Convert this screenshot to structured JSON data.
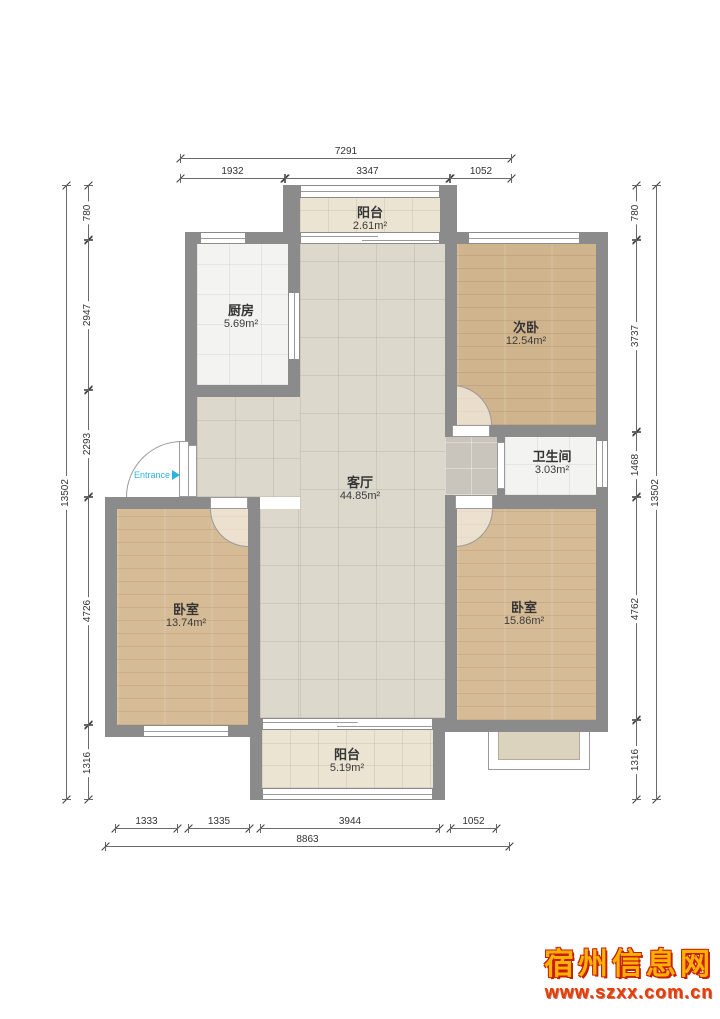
{
  "rooms": {
    "balcony_top": {
      "name": "阳台",
      "area": "2.61m²"
    },
    "kitchen": {
      "name": "厨房",
      "area": "5.69m²"
    },
    "bedroom_second": {
      "name": "次卧",
      "area": "12.54m²"
    },
    "bathroom": {
      "name": "卫生间",
      "area": "3.03m²"
    },
    "living": {
      "name": "客厅",
      "area": "44.85m²"
    },
    "bedroom_left": {
      "name": "卧室",
      "area": "13.74m²"
    },
    "bedroom_right": {
      "name": "卧室",
      "area": "15.86m²"
    },
    "balcony_bottom": {
      "name": "阳台",
      "area": "5.19m²"
    }
  },
  "entrance": {
    "label": "Entrance"
  },
  "dimensions": {
    "top": {
      "total": "7291",
      "segments": [
        "1932",
        "3347",
        "1052"
      ]
    },
    "bottom": {
      "total": "8863",
      "segments": [
        "1333",
        "1335",
        "3944",
        "1052"
      ]
    },
    "left": {
      "total": "13502",
      "segments": [
        "780",
        "2947",
        "2293",
        "4726",
        "1316"
      ]
    },
    "right": {
      "total": "13502",
      "segments": [
        "780",
        "3737",
        "1468",
        "4762",
        "1316"
      ]
    }
  },
  "watermark": {
    "site_name": "宿州信息网",
    "site_url": "www.szxx.com.cn"
  },
  "colors": {
    "wall": "#8b8b8b",
    "entrance_accent": "#2ab5dd",
    "watermark_gold": "#ffb103",
    "watermark_red": "#e83c00"
  }
}
